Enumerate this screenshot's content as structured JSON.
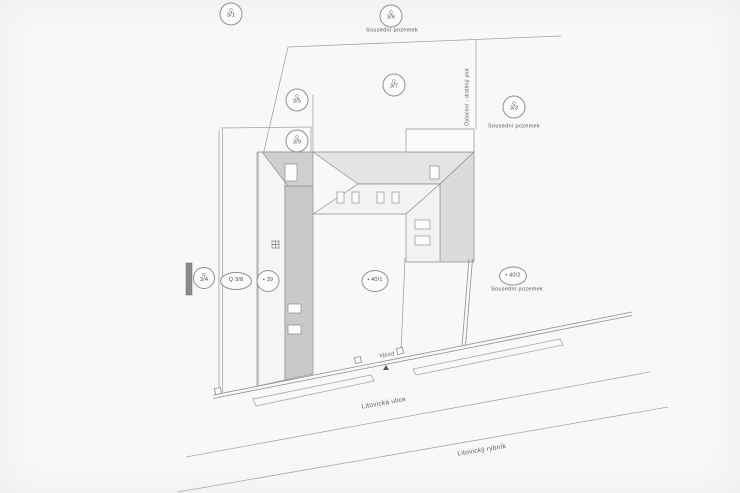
{
  "drawing": {
    "kind": "site-plan-scan",
    "line_color": "#9a9a98",
    "roof_dark": "#c9c9c7",
    "roof_mid": "#dbdbd9",
    "roof_light": "#e4e4e2",
    "paper": "#f8f8f6"
  },
  "markers": [
    {
      "name": "parcel-3-1",
      "style": "twoline",
      "prefix": "Q",
      "number": "3/1",
      "x": 231,
      "y": 14,
      "w": 21,
      "h": 21
    },
    {
      "name": "parcel-3-6",
      "style": "twoline",
      "prefix": "Q",
      "number": "3/6",
      "x": 391,
      "y": 16,
      "w": 21,
      "h": 21
    },
    {
      "name": "parcel-3-5",
      "style": "twoline",
      "prefix": "Q",
      "number": "3/5",
      "x": 297,
      "y": 100,
      "w": 21,
      "h": 21
    },
    {
      "name": "parcel-3-7",
      "style": "twoline",
      "prefix": "Q",
      "number": "3/7",
      "x": 394,
      "y": 85,
      "w": 21,
      "h": 21
    },
    {
      "name": "parcel-3-9",
      "style": "twoline",
      "prefix": "Q",
      "number": "3/9",
      "x": 297,
      "y": 141,
      "w": 21,
      "h": 21
    },
    {
      "name": "parcel-3-3",
      "style": "twoline",
      "prefix": "Q",
      "number": "3/3",
      "x": 514,
      "y": 107,
      "w": 21,
      "h": 21
    },
    {
      "name": "parcel-3-4",
      "style": "twoline",
      "prefix": "Q",
      "number": "3/4",
      "x": 204,
      "y": 278,
      "w": 20,
      "h": 20
    },
    {
      "name": "parcel-3-8",
      "style": "oneline",
      "text": "Q 3/8",
      "x": 236,
      "y": 281,
      "w": 30,
      "h": 16
    },
    {
      "name": "building-39",
      "style": "oneline",
      "text": "• 39",
      "x": 268,
      "y": 281,
      "w": 21,
      "h": 20
    },
    {
      "name": "parcel-40-1",
      "style": "oneline",
      "text": "• 40/1",
      "x": 375,
      "y": 281,
      "w": 25,
      "h": 20
    },
    {
      "name": "parcel-40-2",
      "style": "oneline",
      "text": "• 40/2",
      "x": 513,
      "y": 276,
      "w": 26,
      "h": 17
    }
  ],
  "labels": [
    {
      "name": "neighbor-plot-top",
      "text": "Sousední pozemek",
      "x": 392,
      "y": 31,
      "size": 5.5,
      "rot": 0
    },
    {
      "name": "neighbor-plot-right",
      "text": "Sousední pozemek",
      "x": 514,
      "y": 127,
      "size": 5.5,
      "rot": 0
    },
    {
      "name": "neighbor-plot-bottom-right",
      "text": "Sousední pozemek",
      "x": 517,
      "y": 290,
      "size": 5.5,
      "rot": 0
    },
    {
      "name": "fence-note",
      "text": "Oplocení - drátěný plot",
      "x": 468,
      "y": 97,
      "size": 5,
      "rot": -90
    },
    {
      "name": "entrance",
      "text": "Vjezd",
      "x": 387,
      "y": 356,
      "size": 5.5,
      "rot": -9
    },
    {
      "name": "street-name",
      "text": "Litovická ulice",
      "x": 384,
      "y": 404,
      "size": 6.5,
      "rot": -10
    },
    {
      "name": "pond-name",
      "text": "Litovický rybník",
      "x": 482,
      "y": 451,
      "size": 6.5,
      "rot": -9
    }
  ]
}
